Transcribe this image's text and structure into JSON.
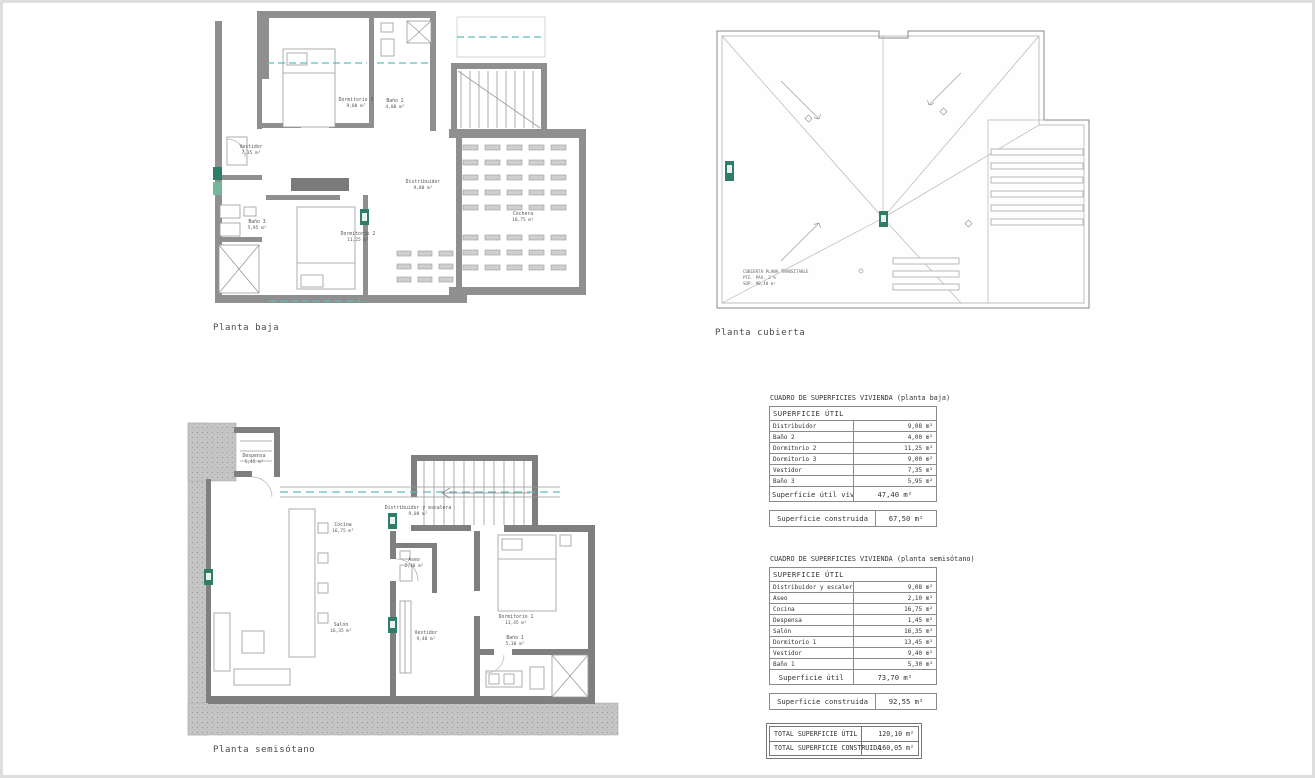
{
  "sheet": {
    "type": "architectural-plan-sheet",
    "background": "#ffffff"
  },
  "palette": {
    "accent_teal": "#5fbdb9",
    "marker_green": "#2f7d68",
    "marker_green_light": "#74b79c",
    "wall_gray": "#8f8f8f",
    "earth_gray": "#c6c6c6",
    "line_gray": "#999999"
  },
  "plans": {
    "baja": {
      "title": "Planta baja",
      "rooms": [
        {
          "name": "Vestidor",
          "area": "7,35 m²"
        },
        {
          "name": "Baño 3",
          "area": "5,95 m²"
        },
        {
          "name": "Dormitorio 3",
          "area": "9,00 m²"
        },
        {
          "name": "Baño 2",
          "area": "4,00 m²"
        },
        {
          "name": "Distribuidor",
          "area": "9,08 m²"
        },
        {
          "name": "Dormitorio 2",
          "area": "11,25 m²"
        },
        {
          "name": "Cochera",
          "area": "18,75 m²"
        }
      ]
    },
    "cubierta": {
      "title": "Planta cubierta",
      "note_lines": [
        "CUBIERTA PLANA TRANSITABLE",
        "PTE. PAV. 2 %",
        "SUP. 90,40 m²"
      ]
    },
    "semisotano": {
      "title": "Planta semisótano",
      "rooms": [
        {
          "name": "Despensa",
          "area": "1,45 m²"
        },
        {
          "name": "Cocina",
          "area": "16,75 m²"
        },
        {
          "name": "Distribuidor y escalera",
          "area": "9,08 m²"
        },
        {
          "name": "Aseo",
          "area": "2,10 m²"
        },
        {
          "name": "Salón",
          "area": "16,35 m²"
        },
        {
          "name": "Vestidor",
          "area": "9,40 m²"
        },
        {
          "name": "Dormitorio 1",
          "area": "13,45 m²"
        },
        {
          "name": "Baño 1",
          "area": "5,30 m²"
        }
      ]
    }
  },
  "tables": {
    "baja": {
      "caption": "CUADRO DE SUPERFICIES VIVIENDA (planta baja)",
      "header": "SUPERFICIE  ÚTIL",
      "rows": [
        {
          "label": "Distribuidor",
          "value": "9,08 m²"
        },
        {
          "label": "Baño 2",
          "value": "4,00 m²"
        },
        {
          "label": "Dormitorio 2",
          "value": "11,25 m²"
        },
        {
          "label": "Dormitorio 3",
          "value": "9,00 m²"
        },
        {
          "label": "Vestidor",
          "value": "7,35 m²"
        },
        {
          "label": "Baño 3",
          "value": "5,95 m²"
        }
      ],
      "total": {
        "label": "Superficie útil vivienda",
        "value": "47,40 m²"
      },
      "built": {
        "label": "Superficie construida",
        "value": "67,50 m²"
      }
    },
    "semisotano": {
      "caption": "CUADRO DE SUPERFICIES VIVIENDA (planta semisótano)",
      "header": "SUPERFICIE  ÚTIL",
      "rows": [
        {
          "label": "Distribuidor y escalera",
          "value": "9,08 m²"
        },
        {
          "label": "Aseo",
          "value": "2,10 m²"
        },
        {
          "label": "Cocina",
          "value": "16,75 m²"
        },
        {
          "label": "Despensa",
          "value": "1,45 m²"
        },
        {
          "label": "Salón",
          "value": "16,35 m²"
        },
        {
          "label": "Dormitorio 1",
          "value": "13,45 m²"
        },
        {
          "label": "Vestidor",
          "value": "9,40 m²"
        },
        {
          "label": "Baño 1",
          "value": "5,30 m²"
        }
      ],
      "total": {
        "label": "Superficie útil",
        "value": "73,70 m²"
      },
      "built": {
        "label": "Superficie construida",
        "value": "92,55 m²"
      }
    },
    "totals": {
      "rows": [
        {
          "label": "TOTAL SUPERFICIE  ÚTIL",
          "value": "120,10 m²"
        },
        {
          "label": "TOTAL SUPERFICIE  CONSTRUIDA",
          "value": "160,05 m²"
        }
      ]
    }
  }
}
